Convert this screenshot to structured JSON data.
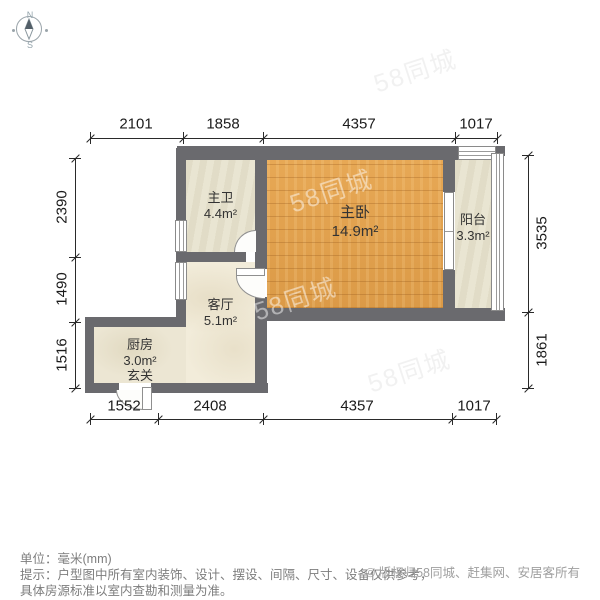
{
  "compass": {
    "north": "N",
    "south": "S"
  },
  "dimensions": {
    "top": [
      "2101",
      "1858",
      "4357",
      "1017"
    ],
    "bottom": [
      "1552",
      "2408",
      "4357",
      "1017"
    ],
    "left": [
      "2390",
      "1490",
      "1516"
    ],
    "right": [
      "3535",
      "1861"
    ]
  },
  "rooms": [
    {
      "name": "主卫",
      "area": "4.4m²"
    },
    {
      "name": "主卧",
      "area": "14.9m²"
    },
    {
      "name": "阳台",
      "area": "3.3m²"
    },
    {
      "name": "客厅",
      "area": "5.1m²"
    },
    {
      "name": "厨房",
      "area": "3.0m²"
    },
    {
      "name": "玄关",
      "area": ""
    }
  ],
  "watermark": {
    "text": "58同城"
  },
  "footer": {
    "unit": "单位：毫米(mm)",
    "tip1": "提示：户型图中所有室内装饰、设计、摆设、间隔、尺寸、设备仅供参考，",
    "tip2": "具体房源标准以室内查勘和测量为准。",
    "copyright": "© 版权归58同城、赶集网、安居客所有"
  },
  "colors": {
    "wall": "#6a6a6e",
    "wood_floor": "#e2a251",
    "tile_floor": "#e9e5d2",
    "marble_floor": "#f2ecda",
    "dim_line": "#2a2a2a",
    "label_text": "#333333",
    "footer_text": "#7d7d7d",
    "copyright_text": "#9f9f9f"
  }
}
